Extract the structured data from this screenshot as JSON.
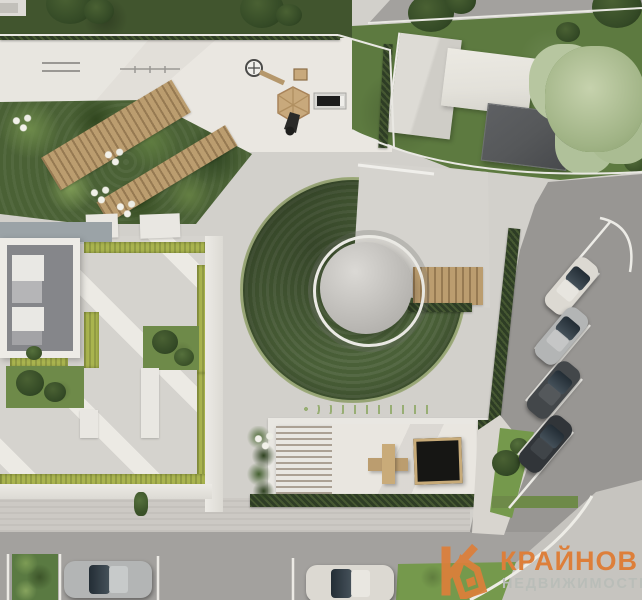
{
  "meta": {
    "kind": "aerial-site-plan-render",
    "width_px": 642,
    "height_px": 600
  },
  "watermark": {
    "brand": "КРАЙНОВ",
    "tagline": "НЕДВИЖИМОСТЬ",
    "logo_icon": "k-house-icon",
    "brand_color": "#dd7f3a",
    "tagline_color": "#b9bdb8"
  },
  "palette": {
    "pavement": "#d2d0cb",
    "pavement-light": "#e2dfd9",
    "pavement-lighter": "#eae7e1",
    "asphalt": "#a3a19e",
    "asphalt-dark": "#989693",
    "grass-dark": "#41552e",
    "grass-mid": "#6e8a49",
    "grass-bright": "#75994c",
    "hedge-dark": "#2e3d25",
    "hedge-yellow": "#a9b44f",
    "mound-green": "#4a6038",
    "wood": "#bb9d6f",
    "slab": "#e9e7e2",
    "roof-light": "#dddbd5",
    "roof-pale": "#e3e1da",
    "roof-dark": "#56585a",
    "white-line": "#eceae5",
    "car-white": "#dcd9d2",
    "car-silver": "#b3b5b5",
    "car-dark": "#43474a",
    "car-black": "#313539",
    "brand-orange": "#dd7f3a",
    "tagline-grey": "#b9bdb8"
  },
  "scene": {
    "regions": [
      "lawn-strip-with-trees",
      "fitness-plaza",
      "playground",
      "diagonal-garden-beds",
      "residential-courtyard",
      "green-mound-with-dome-pavilion",
      "wood-deck",
      "neighbor-houses",
      "diagonal-parking",
      "street-with-parallel-parking",
      "lounge-area-with-pergola-and-firepit"
    ],
    "vehicle_count": 6
  }
}
